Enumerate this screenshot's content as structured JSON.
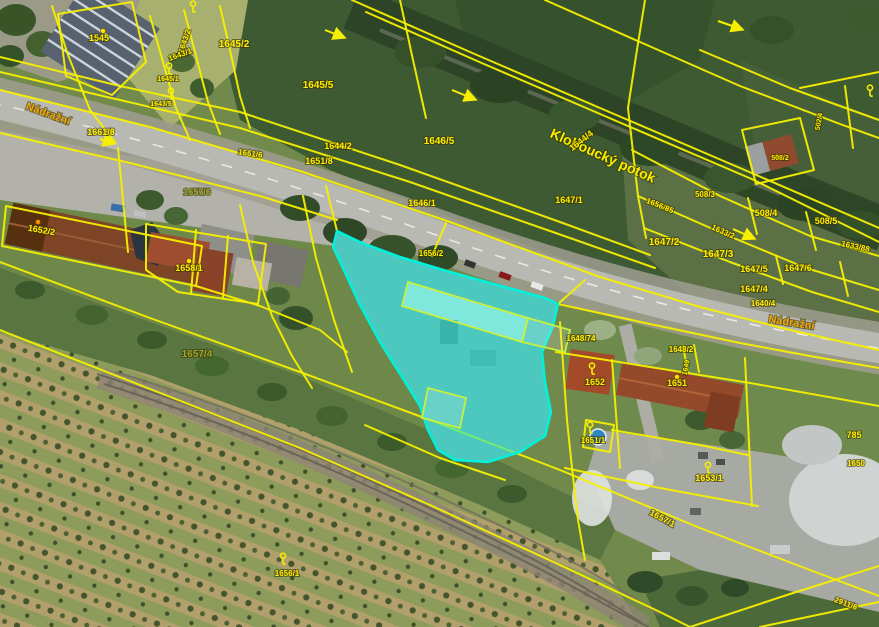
{
  "map": {
    "title": "Katastrální mapa s leteckým snímkem",
    "street_names": [
      "Nádražní",
      "Nádražní"
    ],
    "water_name": "Kloboucký potok",
    "highlighted_parcel": "areál u nádraží",
    "colors": {
      "boundary": "#f6ef00",
      "highlight": "#00f2dc",
      "highlight_fill": "rgba(0,232,214,0.52)",
      "parcel_label": "#ffee00",
      "street_label": "#f0a400",
      "water_label": "#f8ee00",
      "olive_label": "#9aa528"
    },
    "labels": [
      {
        "t": "Nádražní",
        "x": 47,
        "y": 117,
        "r": 20,
        "s": 11,
        "c": "street"
      },
      {
        "t": "Nádražní",
        "x": 791,
        "y": 326,
        "r": 9,
        "s": 11,
        "c": "street"
      },
      {
        "t": "Kloboucký potok",
        "x": 601,
        "y": 160,
        "r": 24,
        "s": 14,
        "c": "water"
      },
      {
        "t": "1545",
        "x": 99,
        "y": 41,
        "r": 0,
        "s": 9,
        "c": "p"
      },
      {
        "t": "1643/2",
        "x": 187,
        "y": 42,
        "r": -72,
        "s": 8,
        "c": "p"
      },
      {
        "t": "1643/1",
        "x": 181,
        "y": 57,
        "r": -20,
        "s": 8,
        "c": "p"
      },
      {
        "t": "1645/2",
        "x": 234,
        "y": 47,
        "r": 0,
        "s": 10,
        "c": "p"
      },
      {
        "t": "1645/5",
        "x": 318,
        "y": 88,
        "r": 0,
        "s": 10,
        "c": "p"
      },
      {
        "t": "1645/1",
        "x": 168,
        "y": 81,
        "r": 0,
        "s": 7,
        "c": "p"
      },
      {
        "t": "1643/5",
        "x": 161,
        "y": 106,
        "r": 0,
        "s": 7,
        "c": "p"
      },
      {
        "t": "1646/5",
        "x": 439,
        "y": 144,
        "r": 0,
        "s": 10,
        "c": "p"
      },
      {
        "t": "1644/4",
        "x": 583,
        "y": 143,
        "r": -38,
        "s": 9,
        "c": "p"
      },
      {
        "t": "1644/2",
        "x": 338,
        "y": 149,
        "r": 0,
        "s": 9,
        "c": "p"
      },
      {
        "t": "1651/8",
        "x": 319,
        "y": 164,
        "r": 0,
        "s": 9,
        "c": "p"
      },
      {
        "t": "1661/8",
        "x": 101,
        "y": 135,
        "r": 0,
        "s": 9,
        "c": "p"
      },
      {
        "t": "1661/6",
        "x": 250,
        "y": 156,
        "r": 8,
        "s": 8,
        "c": "p"
      },
      {
        "t": "1656/85",
        "x": 659,
        "y": 208,
        "r": 22,
        "s": 8,
        "c": "p"
      },
      {
        "t": "508/3",
        "x": 705,
        "y": 197,
        "r": 0,
        "s": 8,
        "c": "p"
      },
      {
        "t": "508/4",
        "x": 766,
        "y": 216,
        "r": 0,
        "s": 9,
        "c": "p"
      },
      {
        "t": "508/5",
        "x": 826,
        "y": 224,
        "r": 0,
        "s": 9,
        "c": "p"
      },
      {
        "t": "1633/2",
        "x": 722,
        "y": 234,
        "r": 24,
        "s": 8,
        "c": "p"
      },
      {
        "t": "1647/2",
        "x": 664,
        "y": 245,
        "r": 0,
        "s": 10,
        "c": "p"
      },
      {
        "t": "1647/3",
        "x": 718,
        "y": 257,
        "r": 0,
        "s": 10,
        "c": "p"
      },
      {
        "t": "1633/88",
        "x": 855,
        "y": 249,
        "r": 12,
        "s": 8,
        "c": "p"
      },
      {
        "t": "1647/5",
        "x": 754,
        "y": 272,
        "r": 0,
        "s": 9,
        "c": "p"
      },
      {
        "t": "1647/6",
        "x": 798,
        "y": 271,
        "r": 0,
        "s": 9,
        "c": "p"
      },
      {
        "t": "1647/4",
        "x": 754,
        "y": 292,
        "r": 0,
        "s": 9,
        "c": "p"
      },
      {
        "t": "1640/4",
        "x": 763,
        "y": 306,
        "r": 0,
        "s": 8,
        "c": "p"
      },
      {
        "t": "1646/1",
        "x": 422,
        "y": 206,
        "r": 0,
        "s": 9,
        "c": "p"
      },
      {
        "t": "1647/1",
        "x": 569,
        "y": 203,
        "r": 0,
        "s": 9,
        "c": "p"
      },
      {
        "t": "1656/2",
        "x": 431,
        "y": 256,
        "r": 0,
        "s": 8,
        "c": "p"
      },
      {
        "t": "1657/6",
        "x": 197,
        "y": 195,
        "r": 0,
        "s": 9,
        "c": "olive"
      },
      {
        "t": "1652/2",
        "x": 41,
        "y": 233,
        "r": 10,
        "s": 9,
        "c": "p"
      },
      {
        "t": "1658/1",
        "x": 189,
        "y": 271,
        "r": 0,
        "s": 9,
        "c": "p"
      },
      {
        "t": "1648/74",
        "x": 581,
        "y": 341,
        "r": 0,
        "s": 8,
        "c": "p"
      },
      {
        "t": "1648/2",
        "x": 681,
        "y": 352,
        "r": 0,
        "s": 8,
        "c": "p"
      },
      {
        "t": "1652",
        "x": 595,
        "y": 385,
        "r": 0,
        "s": 9,
        "c": "p"
      },
      {
        "t": "1651",
        "x": 677,
        "y": 386,
        "r": 0,
        "s": 9,
        "c": "p"
      },
      {
        "t": "1649",
        "x": 688,
        "y": 368,
        "r": -78,
        "s": 7,
        "c": "p"
      },
      {
        "t": "785",
        "x": 854,
        "y": 438,
        "r": 0,
        "s": 9,
        "c": "p"
      },
      {
        "t": "1650",
        "x": 856,
        "y": 466,
        "r": 0,
        "s": 8,
        "c": "p"
      },
      {
        "t": "1651/1",
        "x": 593,
        "y": 443,
        "r": 0,
        "s": 8,
        "c": "p"
      },
      {
        "t": "1653/1",
        "x": 709,
        "y": 481,
        "r": 0,
        "s": 9,
        "c": "p"
      },
      {
        "t": "1657/4",
        "x": 197,
        "y": 357,
        "r": 0,
        "s": 10,
        "c": "olive"
      },
      {
        "t": "1657/1",
        "x": 661,
        "y": 521,
        "r": 28,
        "s": 9,
        "c": "p"
      },
      {
        "t": "1656/1",
        "x": 287,
        "y": 576,
        "r": 0,
        "s": 8,
        "c": "p"
      },
      {
        "t": "2911/6",
        "x": 845,
        "y": 606,
        "r": 20,
        "s": 8,
        "c": "p"
      },
      {
        "t": "502/4",
        "x": 821,
        "y": 122,
        "r": -80,
        "s": 7,
        "c": "p"
      },
      {
        "t": "508/2",
        "x": 780,
        "y": 160,
        "r": 0,
        "s": 7,
        "c": "p"
      }
    ],
    "markers": {
      "keys": [
        [
          193,
          10
        ],
        [
          169,
          72
        ],
        [
          171,
          97
        ],
        [
          592,
          372
        ],
        [
          590,
          431
        ],
        [
          708,
          471
        ],
        [
          283,
          562
        ],
        [
          870,
          94
        ]
      ],
      "dots": [
        [
          103,
          31,
          "#ffe000"
        ],
        [
          38,
          222,
          "#ff9000"
        ],
        [
          189,
          261,
          "#ffe000"
        ],
        [
          677,
          377,
          "#ffe000"
        ],
        [
          777,
          156,
          "#ff9000"
        ]
      ],
      "arrows": [
        [
          325,
          30,
          343,
          37
        ],
        [
          452,
          90,
          474,
          99
        ],
        [
          718,
          21,
          741,
          29
        ],
        [
          100,
          139,
          113,
          143
        ],
        [
          733,
          229,
          753,
          238
        ]
      ]
    }
  }
}
